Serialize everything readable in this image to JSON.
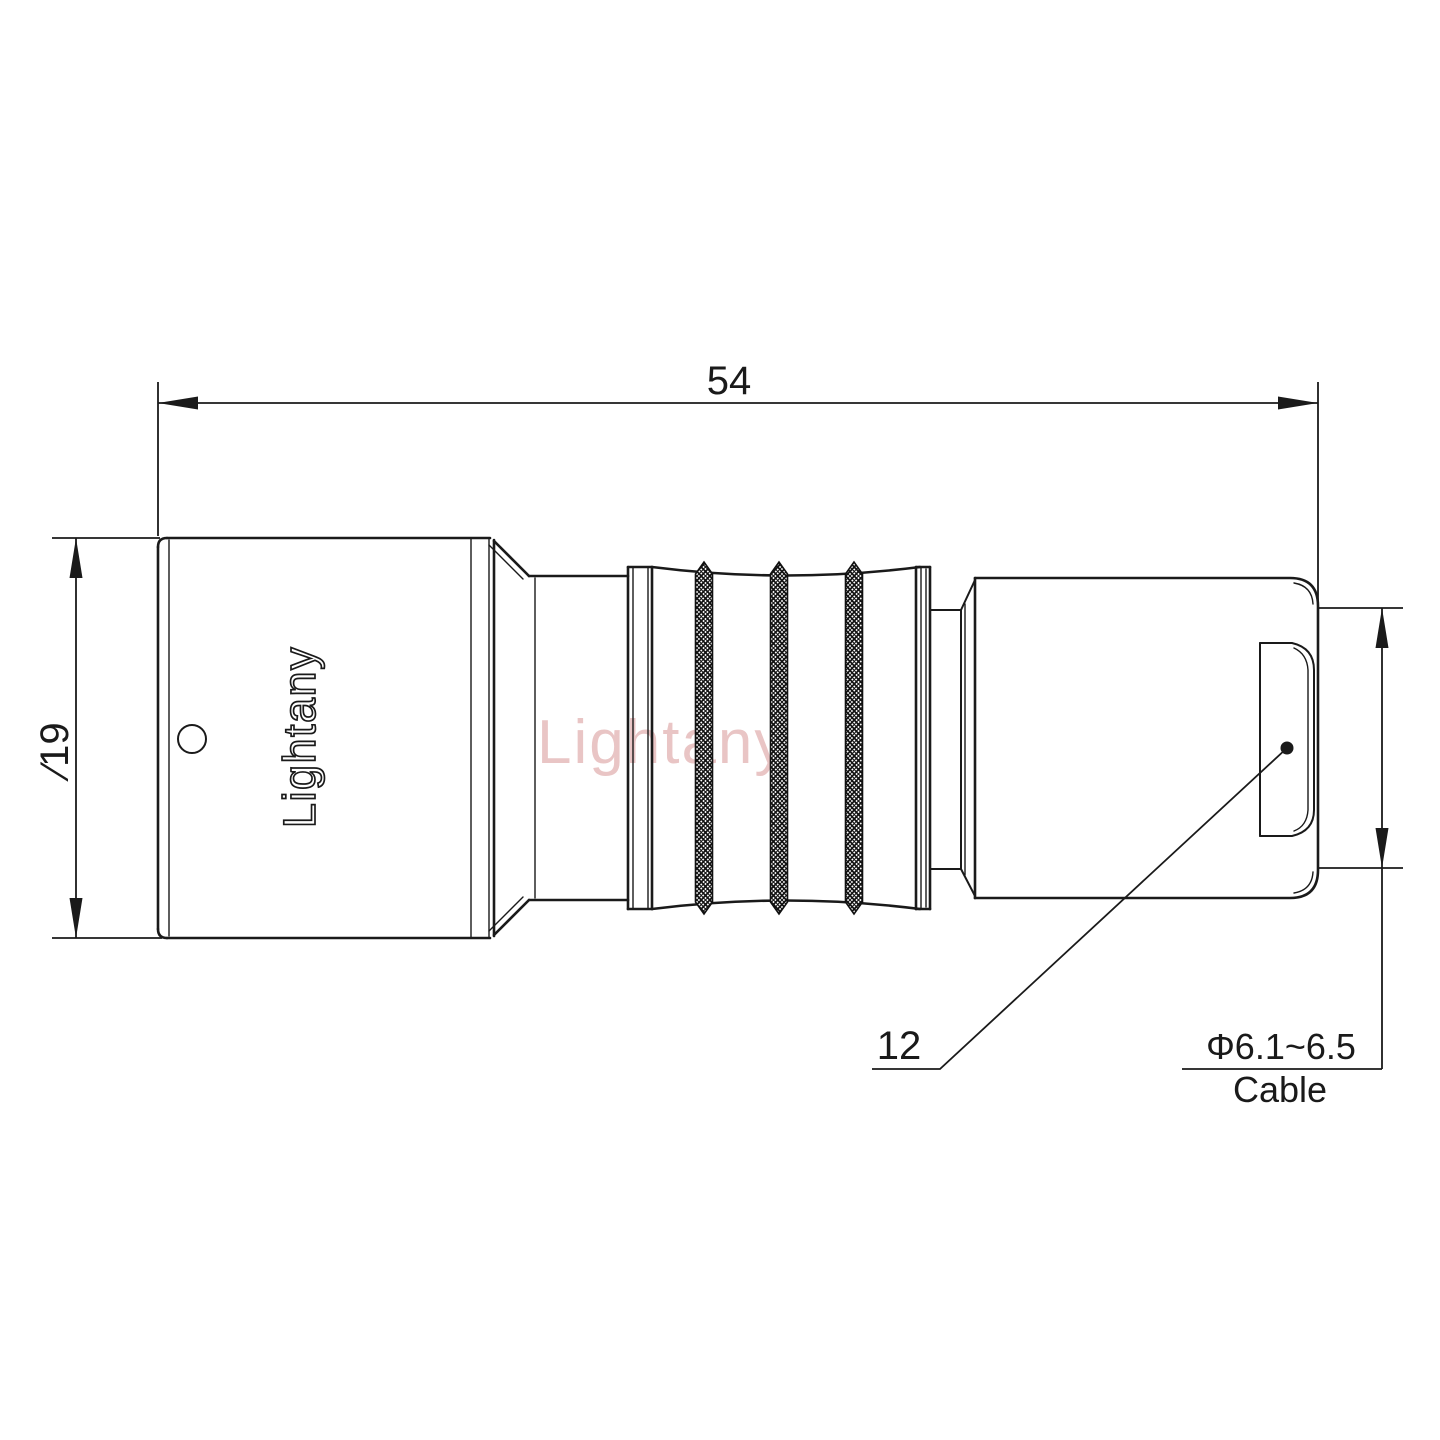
{
  "drawing": {
    "brand_engraving": "Lightany",
    "watermark": "Lightany",
    "colors": {
      "line": "#1a1a1a",
      "watermark": "#cc7777",
      "background": "#ffffff"
    },
    "dims": {
      "overall_length": "54",
      "body_diameter": "∕19",
      "nut_diameter": "12",
      "cable_spec": "Φ6.1~6.5",
      "cable_word": "Cable"
    }
  }
}
